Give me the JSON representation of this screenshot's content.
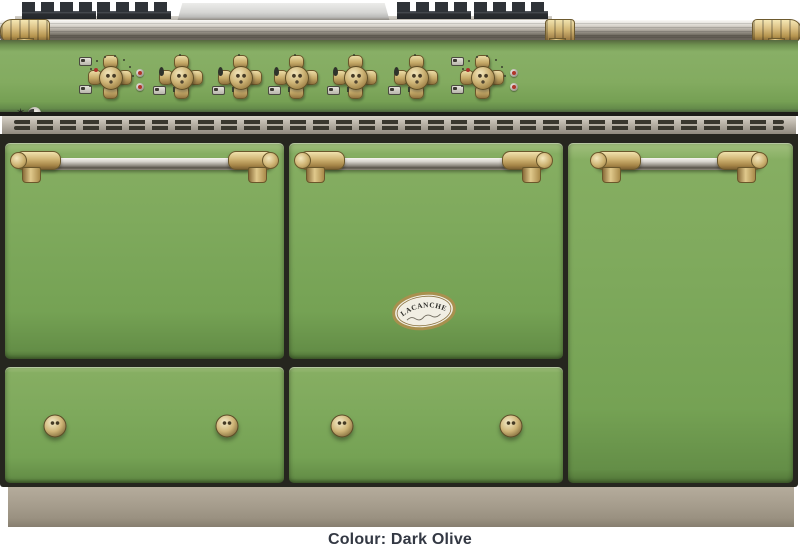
{
  "product": {
    "badge_title": "LACANCHE",
    "badge_subtitle_style": "illegible-script-flourish",
    "finish_name": "Dark Olive"
  },
  "caption": {
    "text": "Colour: Dark Olive"
  },
  "colors": {
    "body_green": "#7ea95c",
    "panel_green": "#83ab60",
    "brass": "#cfb577",
    "stainless": "#b7b1a6",
    "frame_dark": "#26261f",
    "plinth_taupe": "#a89f8f",
    "indicator_red": "#b0342a",
    "caption_text": "#333843",
    "badge_cream": "#f1eee3"
  },
  "icons": {
    "star-icon": "✶",
    "igniter-disc-icon": "circular silver push-button",
    "flame-icon": "small dark gas flame",
    "burner-position-icon": "small rectangle pictogram",
    "oven-dial-ticks": "ring of small setting marks"
  },
  "controls": {
    "knobs": [
      {
        "id": "oven-thermostat-left",
        "type": "oven",
        "x": 110
      },
      {
        "id": "burner-knob-1",
        "type": "burner",
        "x": 181
      },
      {
        "id": "burner-knob-2",
        "type": "burner",
        "x": 240
      },
      {
        "id": "burner-knob-3",
        "type": "burner",
        "x": 296
      },
      {
        "id": "burner-knob-4",
        "type": "burner",
        "x": 355
      },
      {
        "id": "burner-knob-5",
        "type": "burner",
        "x": 416
      },
      {
        "id": "oven-thermostat-right",
        "type": "oven",
        "x": 482
      }
    ],
    "indicator_lights": [
      {
        "x": 136,
        "y": 69
      },
      {
        "x": 136,
        "y": 83
      },
      {
        "x": 510,
        "y": 69
      },
      {
        "x": 510,
        "y": 83
      }
    ],
    "drawer_knobs": [
      {
        "x": 55,
        "y": 426
      },
      {
        "x": 227,
        "y": 426
      },
      {
        "x": 342,
        "y": 426
      },
      {
        "x": 511,
        "y": 426
      }
    ]
  },
  "body_sections": {
    "left": {
      "parts": [
        "oven-door",
        "storage-drawer"
      ]
    },
    "middle": {
      "parts": [
        "oven-door",
        "storage-drawer"
      ],
      "badge": "LACANCHE oval plate"
    },
    "right": {
      "parts": [
        "tall-cupboard-door"
      ]
    }
  },
  "cooktop": {
    "elements": [
      "cast-iron-grate-left",
      "stainless-plancha-centre",
      "cast-iron-grate-right",
      "towel-rail-with-brass-ends"
    ]
  }
}
